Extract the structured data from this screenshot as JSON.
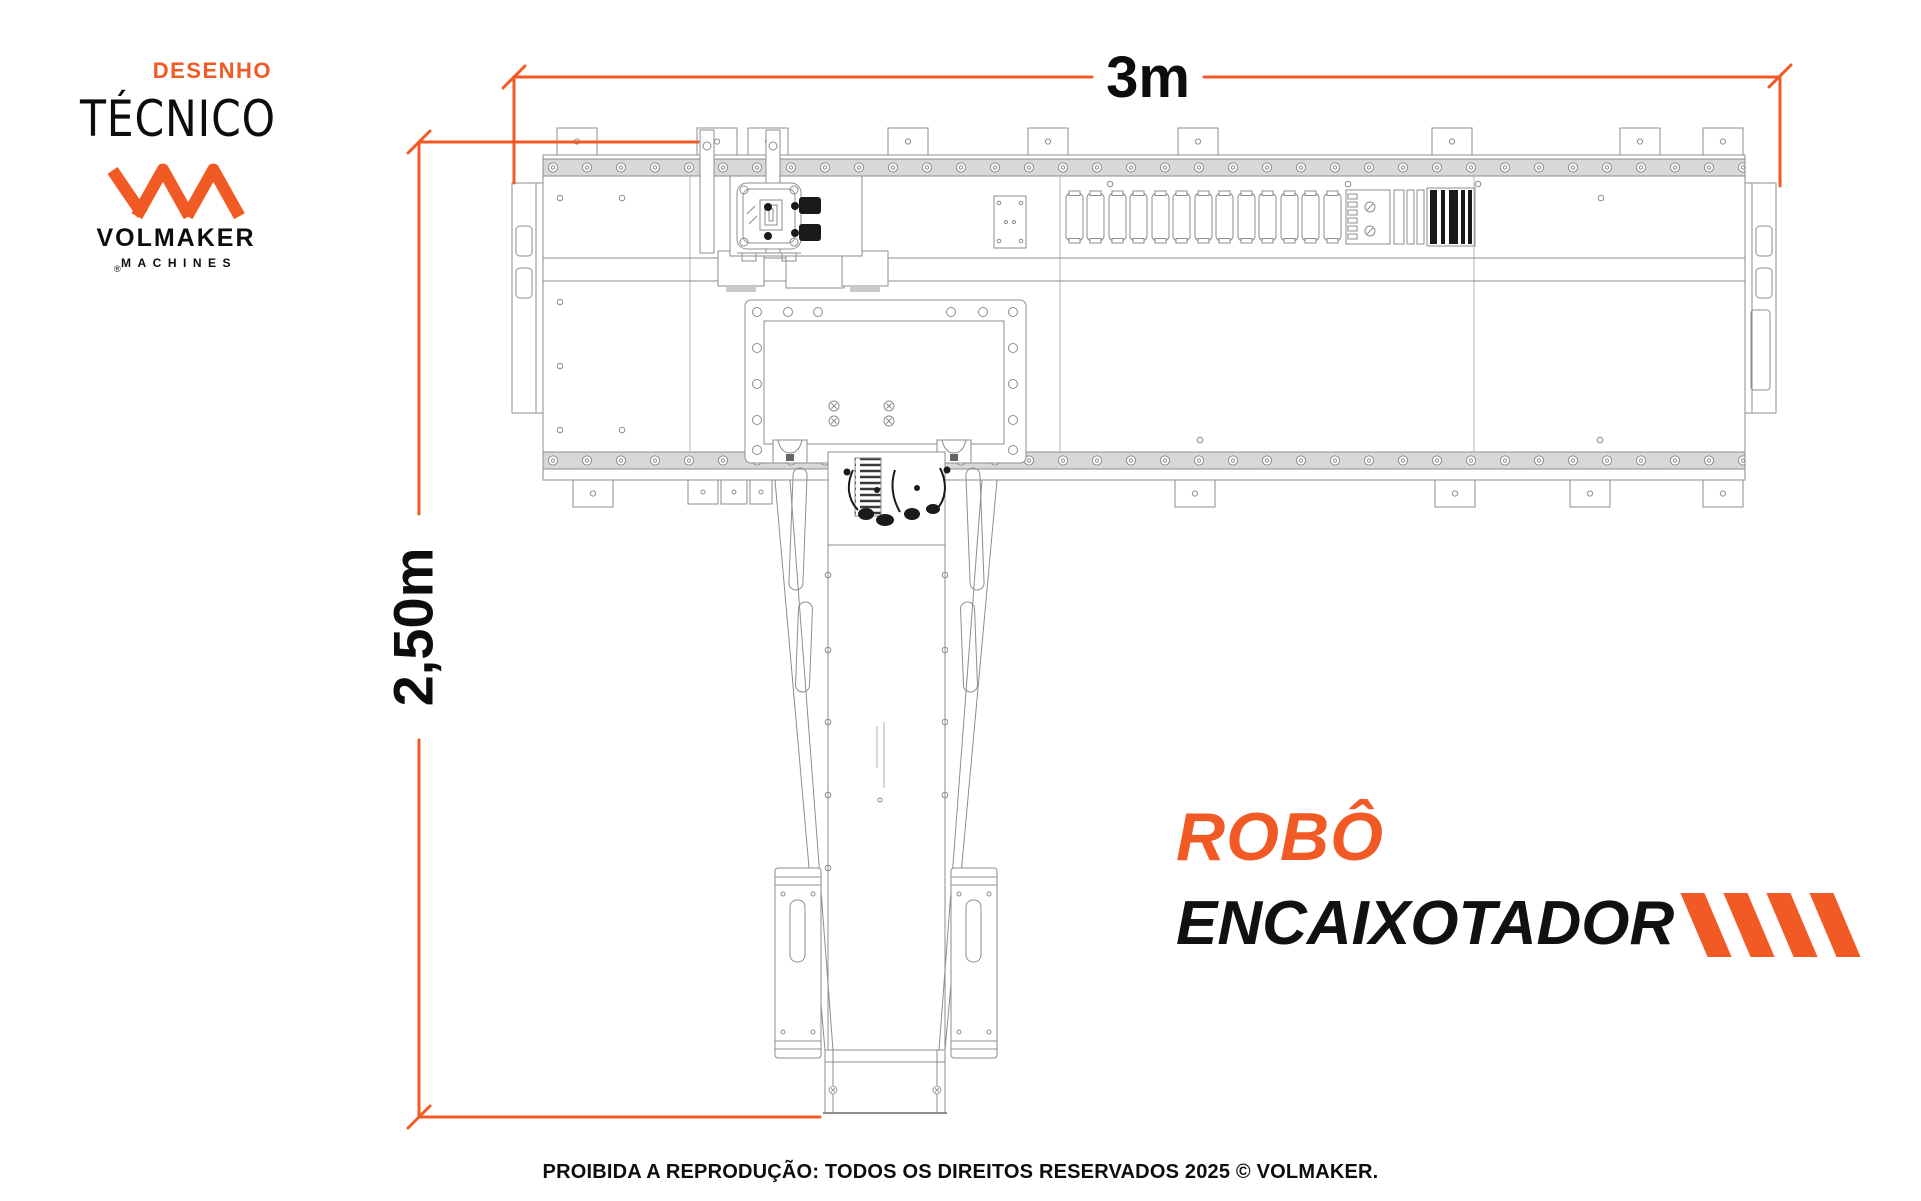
{
  "branding": {
    "subtitle": "DESENHO",
    "title": "TÉCNICO",
    "registered": "®",
    "logo_name": "VOLMAKER",
    "logo_sub": "MACHINES"
  },
  "dimensions": {
    "width_label": "3m",
    "height_label": "2,50m"
  },
  "product": {
    "line1": "ROBÔ",
    "line2": "ENCAIXOTADOR"
  },
  "footer": {
    "copyright": "PROIBIDA A REPRODUÇÃO: TODOS OS DIREITOS RESERVADOS 2025 © VOLMAKER."
  },
  "colors": {
    "accent_orange": "#F15A24",
    "ink": "#0d0d0d",
    "cad_line": "#8d8d8d",
    "cad_fill": "#d8d8d8",
    "detail_black": "#1a1a1a"
  },
  "icons": {
    "logo_mark": "volmaker-vm-monogram-icon",
    "product_stripes": "diagonal-stripes-icon"
  }
}
